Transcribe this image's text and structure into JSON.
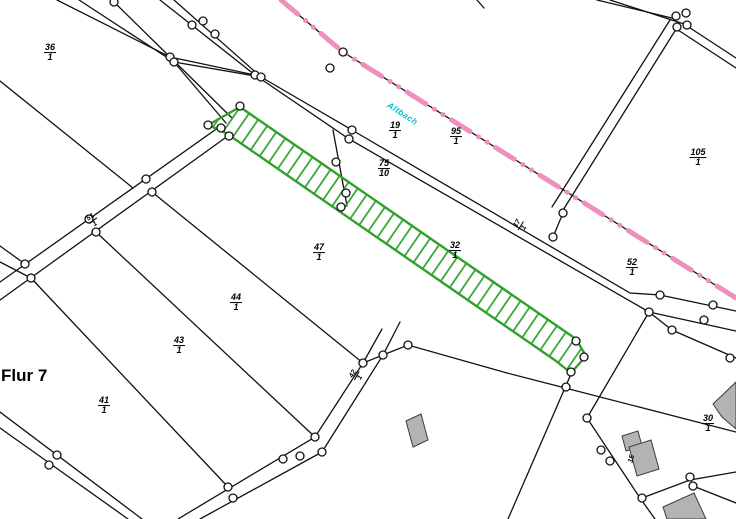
{
  "map": {
    "flur_label": "Flur 7",
    "stream_label": "Altbach",
    "colors": {
      "boundary_ink": "#111111",
      "municipal_boundary_pink": "#ee8fbe",
      "selected_parcel_green": "#2fa12b",
      "stream_label_cyan": "#00c2d1",
      "building_gray": "#b3b3b3"
    },
    "parcel_labels": [
      {
        "num": "36",
        "den": "1",
        "x": 50,
        "y": 53,
        "rot": 0
      },
      {
        "num": "19",
        "den": "1",
        "x": 395,
        "y": 131,
        "rot": 0
      },
      {
        "num": "95",
        "den": "1",
        "x": 456,
        "y": 137,
        "rot": 0
      },
      {
        "num": "105",
        "den": "1",
        "x": 698,
        "y": 158,
        "rot": 0
      },
      {
        "num": "75",
        "den": "10",
        "x": 384,
        "y": 169,
        "rot": 0
      },
      {
        "num": "47",
        "den": "1",
        "x": 319,
        "y": 253,
        "rot": 0
      },
      {
        "num": "32",
        "den": "1",
        "x": 455,
        "y": 251,
        "rot": 0
      },
      {
        "num": "52",
        "den": "1",
        "x": 632,
        "y": 268,
        "rot": 0
      },
      {
        "num": "44",
        "den": "1",
        "x": 236,
        "y": 303,
        "rot": 0
      },
      {
        "num": "43",
        "den": "1",
        "x": 179,
        "y": 346,
        "rot": 0
      },
      {
        "num": "41",
        "den": "1",
        "x": 104,
        "y": 406,
        "rot": 0
      },
      {
        "num": "30",
        "den": "1",
        "x": 708,
        "y": 424,
        "rot": 0
      },
      {
        "num": "42",
        "den": "1",
        "x": 357,
        "y": 376,
        "rot": -62,
        "small": true
      },
      {
        "num": "51",
        "den": "1",
        "x": 93,
        "y": 221,
        "rot": -35,
        "small": true
      },
      {
        "num": "17",
        "den": "1",
        "x": 521,
        "y": 226,
        "rot": -58,
        "small": true
      }
    ],
    "house_labels": [
      {
        "text": "15",
        "x": 632,
        "y": 459,
        "rot": -75
      }
    ],
    "selected_parcel": {
      "description": "hatched green strip parcel"
    }
  }
}
